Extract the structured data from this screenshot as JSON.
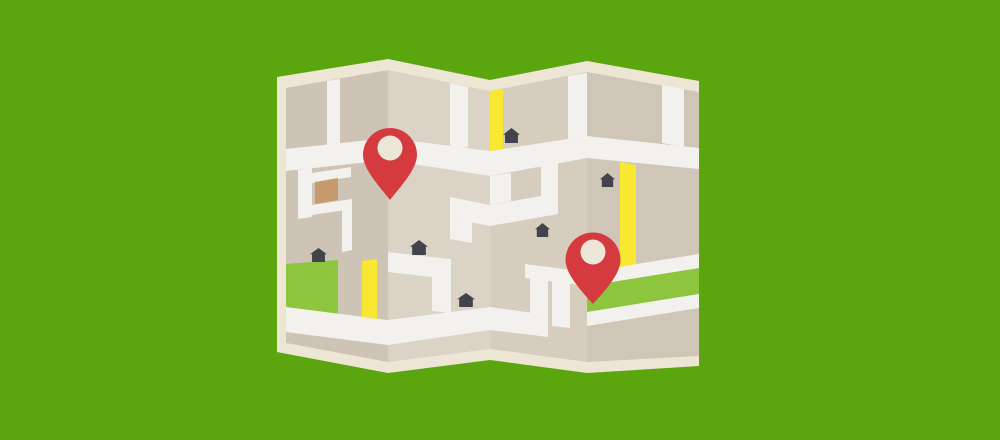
{
  "scene": {
    "width": 1000,
    "height": 440,
    "description": "Flat-design illustration of a folded paper street map with two red location pins on a green background",
    "background_color": "#5ba60e"
  },
  "colors": {
    "background_green": "#5ba60e",
    "paper_border_cream": "#eee6d5",
    "panel_dark_tan": "#cec4b6",
    "panel_light_tan": "#dbd3c5",
    "panel_mid_tan": "#d6cdbf",
    "panel_mid_dark_tan": "#d0c6b8",
    "road_white": "#f2f1ed",
    "road_yellow": "#f8e832",
    "park_green": "#8dc53e",
    "building_brown": "#c59b6e",
    "house_dark": "#42444b",
    "pin_red": "#d43a3e",
    "pin_hole_cream": "#ece6d9"
  },
  "map": {
    "paper_outline": {
      "name": "folded-map-paper",
      "points": "277,77 388,59 490,80 587,61 699,81 699,366 587,373 490,360 388,373 277,352",
      "fill": "#eee6d5"
    },
    "panels": [
      {
        "name": "map-panel-1",
        "points": "286,88 388,70 388,362 286,343",
        "fill": "#cec4b6"
      },
      {
        "name": "map-panel-2",
        "points": "388,70 490,91 490,349 388,362",
        "fill": "#dbd3c5"
      },
      {
        "name": "map-panel-3",
        "points": "490,91 587,72 587,362 490,349",
        "fill": "#d6cdbf"
      },
      {
        "name": "map-panel-4",
        "points": "587,72 699,92 699,356 587,362",
        "fill": "#d0c6b8"
      }
    ],
    "parks": [
      {
        "name": "park-block-panel1",
        "points": "286,264 338,260 338,314 286,308",
        "fill": "#8dc53e"
      },
      {
        "name": "green-band-panel4",
        "points": "587,286 699,268 699,294 587,312",
        "fill": "#8dc53e"
      }
    ],
    "roads": [
      {
        "name": "main-road-panel1",
        "points": "286,149 388,138 388,160 286,171",
        "fill": "#f2f1ed"
      },
      {
        "name": "main-road-panel2",
        "points": "388,138 490,151 490,176 388,160",
        "fill": "#f2f1ed"
      },
      {
        "name": "main-road-panel3",
        "points": "490,151 587,136 587,158 490,176",
        "fill": "#f2f1ed"
      },
      {
        "name": "main-road-panel4",
        "points": "587,136 699,148 699,169 587,158",
        "fill": "#f2f1ed"
      },
      {
        "name": "top-vertical-road-panel1",
        "points": "327,81 340,79 340,146 327,148",
        "fill": "#f2f1ed"
      },
      {
        "name": "side-street-a-panel1",
        "points": "298,170 312,168 312,217 298,219",
        "fill": "#f2f1ed"
      },
      {
        "name": "side-street-b-panel1",
        "points": "312,173 351,167 351,177 312,183",
        "fill": "#f2f1ed"
      },
      {
        "name": "side-street-c-panel1",
        "points": "312,205 352,199 352,209 312,215",
        "fill": "#f2f1ed"
      },
      {
        "name": "side-street-d-panel1",
        "points": "342,209 352,207 352,250 342,252",
        "fill": "#f2f1ed"
      },
      {
        "name": "bottom-road-panel1",
        "points": "286,307 388,320 388,345 286,332",
        "fill": "#f2f1ed"
      },
      {
        "name": "bottom-road-panel2",
        "points": "388,320 490,307 490,330 388,345",
        "fill": "#f2f1ed"
      },
      {
        "name": "top-vertical-road-panel2",
        "points": "450,83 468,87 468,147 450,149",
        "fill": "#f2f1ed"
      },
      {
        "name": "mid-street-panel2",
        "points": "450,197 490,205 490,226 450,218",
        "fill": "#f2f1ed"
      },
      {
        "name": "mid-street-stub-panel2",
        "points": "450,218 472,222 472,243 450,239",
        "fill": "#f2f1ed"
      },
      {
        "name": "house-street-panel2",
        "points": "388,252 432,257 432,277 388,272",
        "fill": "#f2f1ed"
      },
      {
        "name": "vertical-street-panel2",
        "points": "432,257 451,259 451,313 432,311",
        "fill": "#f2f1ed"
      },
      {
        "name": "valley-connector-road",
        "points": "490,176 511,173 511,201 490,205",
        "fill": "#f2f1ed"
      },
      {
        "name": "mid-street-panel3",
        "points": "490,205 558,193 558,214 490,226",
        "fill": "#f2f1ed"
      },
      {
        "name": "mid-street-riser-panel3",
        "points": "541,166 558,163 558,196 541,199",
        "fill": "#f2f1ed"
      },
      {
        "name": "top-vertical-road-panel3",
        "points": "568,76 587,73 587,136 568,139",
        "fill": "#f2f1ed"
      },
      {
        "name": "bottom-road-panel3",
        "points": "490,307 548,315 548,337 490,330",
        "fill": "#f2f1ed"
      },
      {
        "name": "step-street-panel3",
        "points": "530,276 548,279 548,315 530,313",
        "fill": "#f2f1ed"
      },
      {
        "name": "lower-street-panel3",
        "points": "525,264 587,272 587,286 525,278",
        "fill": "#f2f1ed"
      },
      {
        "name": "stub-street-panel3",
        "points": "552,281 570,283 570,328 552,326",
        "fill": "#f2f1ed"
      },
      {
        "name": "road-above-green-band-panel4",
        "points": "587,272 699,254 699,268 587,286",
        "fill": "#f2f1ed"
      },
      {
        "name": "road-below-green-band-panel4",
        "points": "587,312 699,294 699,308 587,326",
        "fill": "#f2f1ed"
      },
      {
        "name": "top-vertical-road-panel4",
        "points": "662,85 684,89 684,147 662,143",
        "fill": "#f2f1ed"
      },
      {
        "name": "yellow-road-panel1",
        "points": "362,261 377,259 377,319 362,317",
        "fill": "#f8e832"
      },
      {
        "name": "yellow-road-panel3",
        "points": "490,91 503,89 503,149 490,151",
        "fill": "#f8e832"
      },
      {
        "name": "yellow-road-panel4",
        "points": "620,162 636,165 636,264 620,267",
        "fill": "#f8e832"
      }
    ],
    "buildings": [
      {
        "name": "brown-building-panel1",
        "points": "315,182 338,178 338,200 315,204",
        "fill": "#c59b6e"
      }
    ],
    "houses": [
      {
        "name": "house-icon-1",
        "x": 310,
        "y": 248,
        "w": 17,
        "h": 14
      },
      {
        "name": "house-icon-2",
        "x": 410,
        "y": 240,
        "w": 18,
        "h": 15
      },
      {
        "name": "house-icon-3",
        "x": 457,
        "y": 293,
        "w": 18,
        "h": 14
      },
      {
        "name": "house-icon-4",
        "x": 503,
        "y": 128,
        "w": 17,
        "h": 15
      },
      {
        "name": "house-icon-5",
        "x": 535,
        "y": 223,
        "w": 15,
        "h": 14
      },
      {
        "name": "house-icon-6",
        "x": 600,
        "y": 173,
        "w": 15,
        "h": 14
      }
    ],
    "pins": [
      {
        "name": "location-pin-icon-1",
        "cx": 390,
        "cy": 155,
        "r": 27,
        "tip_y": 200,
        "hole": {
          "cx": 390,
          "cy": 148,
          "r": 12.5
        }
      },
      {
        "name": "location-pin-icon-2",
        "cx": 593,
        "cy": 260,
        "r": 27.5,
        "tip_y": 304,
        "hole": {
          "cx": 593,
          "cy": 252,
          "r": 12.5
        }
      }
    ]
  }
}
